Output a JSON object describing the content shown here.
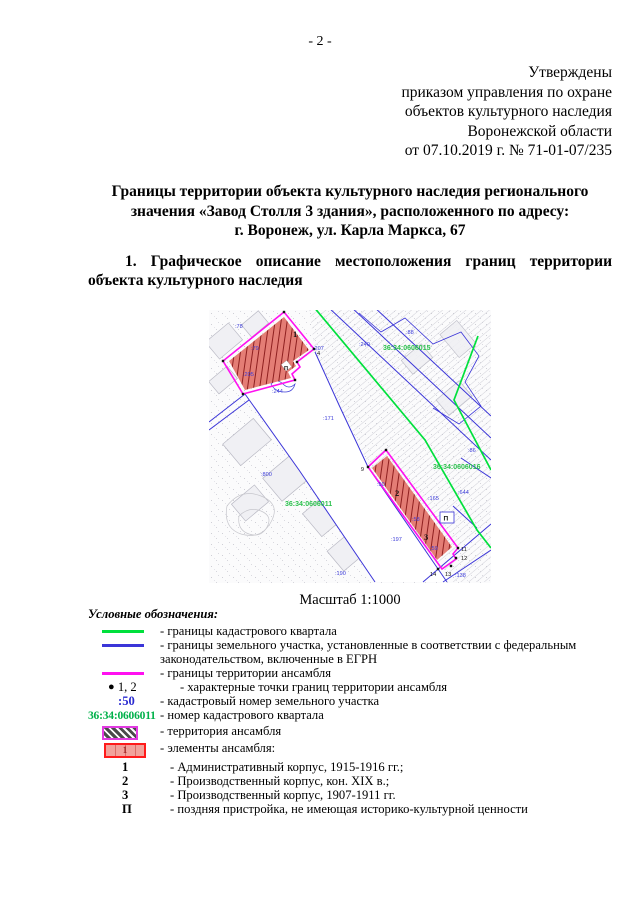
{
  "page": {
    "number": "- 2 -"
  },
  "approval": {
    "lines": [
      "Утверждены",
      "приказом управления по охране",
      "объектов культурного наследия",
      "Воронежской области",
      "от 07.10.2019 г. № 71-01-07/235"
    ]
  },
  "title": {
    "lines": [
      "Границы территории объекта культурного наследия регионального",
      "значения «Завод Столля 3 здания», расположенного по адресу:",
      "г. Воронеж, ул. Карла Маркса, 67"
    ]
  },
  "section1": {
    "line1": "1. Графическое описание местоположения границ территории",
    "line2": "объекта культурного наследия"
  },
  "map": {
    "scale_label": "Масштаб 1:1000",
    "quarter_labels": [
      "36:34:0606015",
      "36:34:0606016",
      "36:34:0606011"
    ],
    "parcel_labels": [
      ":78",
      ":79",
      ":205",
      ":207",
      ":240",
      ":88",
      ":171",
      ":800",
      ":244",
      ":50",
      ":58",
      ":59",
      ":197",
      ":190",
      ":138",
      ":86",
      ":165",
      ":644"
    ],
    "building_labels": [
      "1",
      "2",
      "3"
    ],
    "annex_label": "П",
    "point_labels": [
      "4",
      "9",
      "11",
      "12",
      "13",
      "14"
    ],
    "colors": {
      "quarter_boundary": "#00e03c",
      "parcel_boundary": "#3b35d8",
      "ensemble_boundary": "#ff10f0",
      "ensemble_fill": "#e47d75",
      "parcel_number_text": "#3b3bd8",
      "quarter_number_text": "#2cc14e"
    }
  },
  "legend": {
    "heading": "Условные обозначения:",
    "items": [
      {
        "symbol": "green-line",
        "label": "- границы кадастрового квартала"
      },
      {
        "symbol": "blue-line",
        "label": "- границы земельного участка, установленные в соответствии с федеральным законодательством, включенные в ЕГРН"
      },
      {
        "symbol": "magenta-line",
        "label": "- границы территории ансамбля"
      },
      {
        "symbol": "boundary-point",
        "symbol_text": "1, 2",
        "bullet": "●",
        "label": "- характерные точки границ территории ансамбля"
      },
      {
        "symbol": "parcel-number",
        "symbol_text": ":50",
        "label": "- кадастровый номер земельного участка"
      },
      {
        "symbol": "quarter-number",
        "symbol_text": "36:34:0606011",
        "label": "- номер кадастрового квартала"
      },
      {
        "symbol": "hatch-swatch",
        "label": "- территория ансамбля"
      },
      {
        "symbol": "red-swatch",
        "symbol_text": "1",
        "label": "- элементы ансамбля:"
      },
      {
        "symbol": "element-number",
        "symbol_text": "1",
        "label": "- Административный корпус, 1915-1916 гг.;"
      },
      {
        "symbol": "element-number",
        "symbol_text": "2",
        "label": "- Производственный корпус, кон. XIX в.;"
      },
      {
        "symbol": "element-number",
        "symbol_text": "3",
        "label": "- Производственный корпус, 1907-1911 гг."
      },
      {
        "symbol": "element-number",
        "symbol_text": "П",
        "label": "- поздняя пристройка, не имеющая историко-культурной ценности"
      }
    ]
  }
}
